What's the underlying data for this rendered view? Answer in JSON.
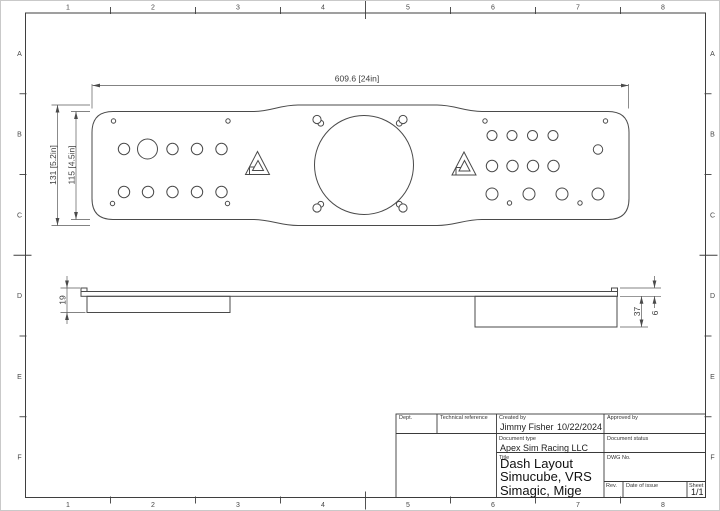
{
  "sheet": {
    "border": {
      "columns": [
        "1",
        "2",
        "3",
        "4",
        "5",
        "6",
        "7",
        "8"
      ],
      "rows": [
        "A",
        "B",
        "C",
        "D",
        "E",
        "F"
      ]
    }
  },
  "dimensions": {
    "overall_width": "609.6 [24in]",
    "overall_height": "131 [5.2in]",
    "inner_height": "115 [4.5in]",
    "left_bracket_height": "19",
    "right_bracket_height": "37",
    "plate_thickness": "6"
  },
  "title_block": {
    "dept_label": "Dept.",
    "technical_reference_label": "Technical reference",
    "created_by_label": "Created by",
    "created_by_name": "Jimmy Fisher",
    "created_by_date": "10/22/2024",
    "approved_by_label": "Approved by",
    "document_type_label": "Document type",
    "document_type_value": "Apex Sim Racing LLC",
    "document_status_label": "Document status",
    "title_label": "Title",
    "title_line1": "Dash Layout",
    "title_line2": "Simucube, VRS",
    "title_line3": "Simagic, Mige",
    "dwg_no_label": "DWG No.",
    "rev_label": "Rev.",
    "date_of_issue_label": "Date of issue",
    "sheet_label": "Sheet",
    "sheet_value": "1/1"
  },
  "colors": {
    "line": "#4a4a4a",
    "text": "#222222",
    "background": "#ffffff"
  }
}
